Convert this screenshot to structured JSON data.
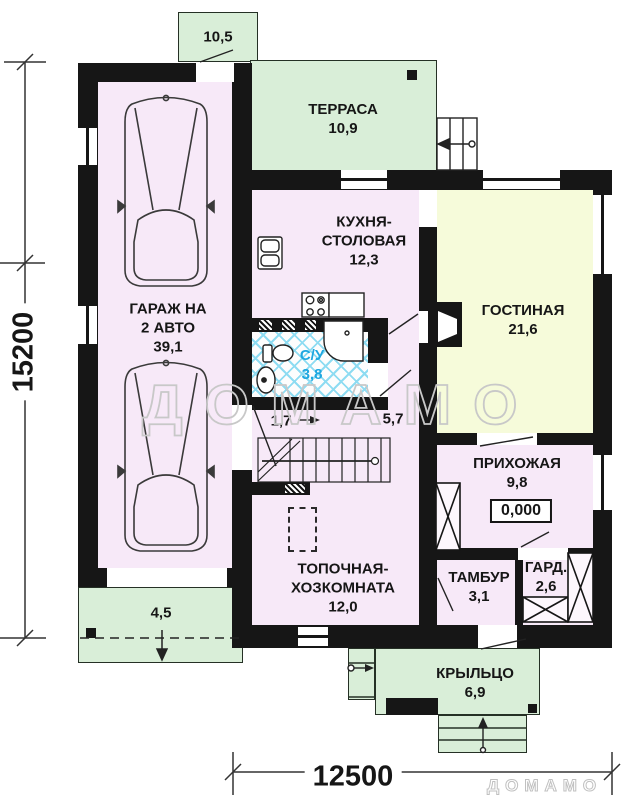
{
  "plan_title": "first-floor-plan",
  "watermark": {
    "center": "ДОМАМО",
    "corner": "ДОМАМО"
  },
  "dimensions": {
    "height_label": "15200",
    "width_label": "12500"
  },
  "rooms": {
    "canopy": {
      "area": "10,5"
    },
    "terrace": {
      "name": "ТЕРРАСА",
      "area": "10,9"
    },
    "garage": {
      "name_line1": "ГАРАЖ НА",
      "name_line2": "2 АВТО",
      "area": "39,1"
    },
    "kitchen": {
      "name_line1": "КУХНЯ-",
      "name_line2": "СТОЛОВАЯ",
      "area": "12,3"
    },
    "living": {
      "name": "ГОСТИНАЯ",
      "area": "21,6"
    },
    "bathroom": {
      "name": "С/У",
      "area": "3,8"
    },
    "hall_small": {
      "area": "1,7"
    },
    "hall": {
      "area": "5,7"
    },
    "entry": {
      "name": "ПРИХОЖАЯ",
      "area": "9,8",
      "elevation": "0,000"
    },
    "boiler": {
      "name_line1": "ТОПОЧНАЯ-",
      "name_line2": "ХОЗКОМНАТА",
      "area": "12,0"
    },
    "vestibule": {
      "name": "ТАМБУР",
      "area": "3,1"
    },
    "wardrobe": {
      "name": "ГАРД.",
      "area": "2,6"
    },
    "porch": {
      "name": "КРЫЛЬЦО",
      "area": "6,9"
    },
    "apron": {
      "area": "4,5"
    }
  },
  "colors": {
    "wall": "#161616",
    "room_fill": "#f7e9f8",
    "living_fill": "#f6fbda",
    "outdoor_fill": "#d9eed8",
    "tile_accent": "#1ea7e0",
    "watermark": "#c8c8c8"
  }
}
